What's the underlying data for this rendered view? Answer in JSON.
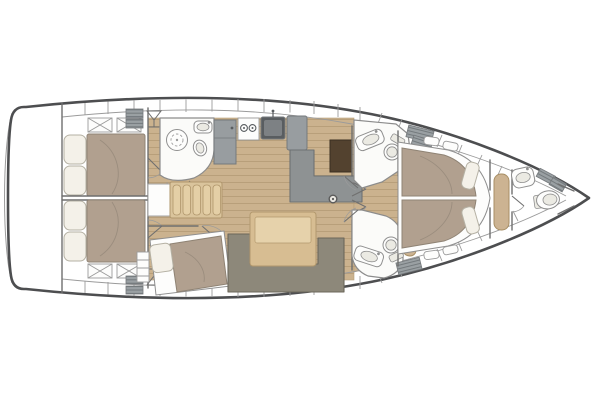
{
  "diagram": {
    "type": "sailboat-interior-floor-plan",
    "view": "top-down",
    "orientation": "bow-right-stern-left",
    "rooms": [
      {
        "id": "swim-platform",
        "label": "transom swim platform",
        "features": []
      },
      {
        "id": "aft-cabin-top",
        "label": "aft double cabin (top)",
        "features": [
          "double-bed",
          "two-pillows",
          "two-deck-hatches",
          "hanging-locker"
        ]
      },
      {
        "id": "aft-cabin-bottom",
        "label": "aft double cabin (bottom)",
        "features": [
          "double-bed",
          "two-pillows",
          "two-deck-hatches",
          "hanging-locker"
        ]
      },
      {
        "id": "aft-head",
        "label": "aft head with shower (top)",
        "features": [
          "shower-grate",
          "sink",
          "toilet",
          "door"
        ]
      },
      {
        "id": "galley",
        "label": "galley (top center)",
        "features": [
          "fridge",
          "two-burner-stove",
          "sink",
          "counter"
        ]
      },
      {
        "id": "companionway",
        "label": "companionway steps with landing",
        "features": [
          "five-steps",
          "landing"
        ]
      },
      {
        "id": "single-berth-cabin",
        "label": "mid single berth cabin (bottom)",
        "features": [
          "single-bed",
          "pillow",
          "shelf-unit",
          "door"
        ]
      },
      {
        "id": "salon",
        "label": "salon",
        "features": [
          "l-shaped-chaise",
          "dark-cabinet",
          "dining-table",
          "u-shaped-settee",
          "mast-post"
        ]
      },
      {
        "id": "mid-head-top",
        "label": "forward head (top side)",
        "features": [
          "sink",
          "toilet",
          "door"
        ]
      },
      {
        "id": "mid-head-bottom",
        "label": "forward head (bottom side)",
        "features": [
          "sink",
          "toilet",
          "bench",
          "door"
        ]
      },
      {
        "id": "forward-cabin",
        "label": "forward owner cabin",
        "features": [
          "island-double-bed",
          "two-pillows",
          "side-shelves",
          "bench-seat",
          "double-doors"
        ]
      },
      {
        "id": "bow-head",
        "label": "bow head",
        "features": [
          "sink",
          "toilet",
          "storage-lockers"
        ]
      }
    ],
    "storage": [
      "hull-side-locker-compartments",
      "hatched-storage-boxes"
    ],
    "symbols": [
      "martini-glass-hanging-locker",
      "x-cross-deck-hatches",
      "door-swing-arcs"
    ]
  },
  "colors": {
    "hull_outline": "#4d4e50",
    "wall": "#6f6f6f",
    "thin": "#9b9b9b",
    "floor": "#cbb28e",
    "floor_line": "#b69d78",
    "duvet": "#b1a08f",
    "duvet_edge": "#8f8374",
    "pillow": "#f4f1e9",
    "pillow_edge": "#b5b1a4",
    "counter": "#989da0",
    "counter_edge": "#75797c",
    "appliance": "#595d60",
    "settee": "#8e9293",
    "settee_edge": "#6d7173",
    "dinette": "#8d887a",
    "dinette_edge": "#6c675b",
    "table": "#d7bd92",
    "table_edge": "#b2986d",
    "table_top": "#e6d2ab",
    "stairs": "#dac49c",
    "stair_slat": "#e4cfa6",
    "stair_edge": "#b0966c",
    "bench": "#ccb392",
    "bench_edge": "#a78e64",
    "dark_cabinet": "#53422f",
    "dark_cabinet_edge": "#3a2e20",
    "room": "#fbfbf9",
    "room_edge": "#8c8c8c",
    "fixture": "#fdfdfc",
    "fixture_edge": "#8f8f8f",
    "basin": "#ebeae3",
    "hatch_bg": "#9aa0a3",
    "hatch_line": "#73797c"
  }
}
